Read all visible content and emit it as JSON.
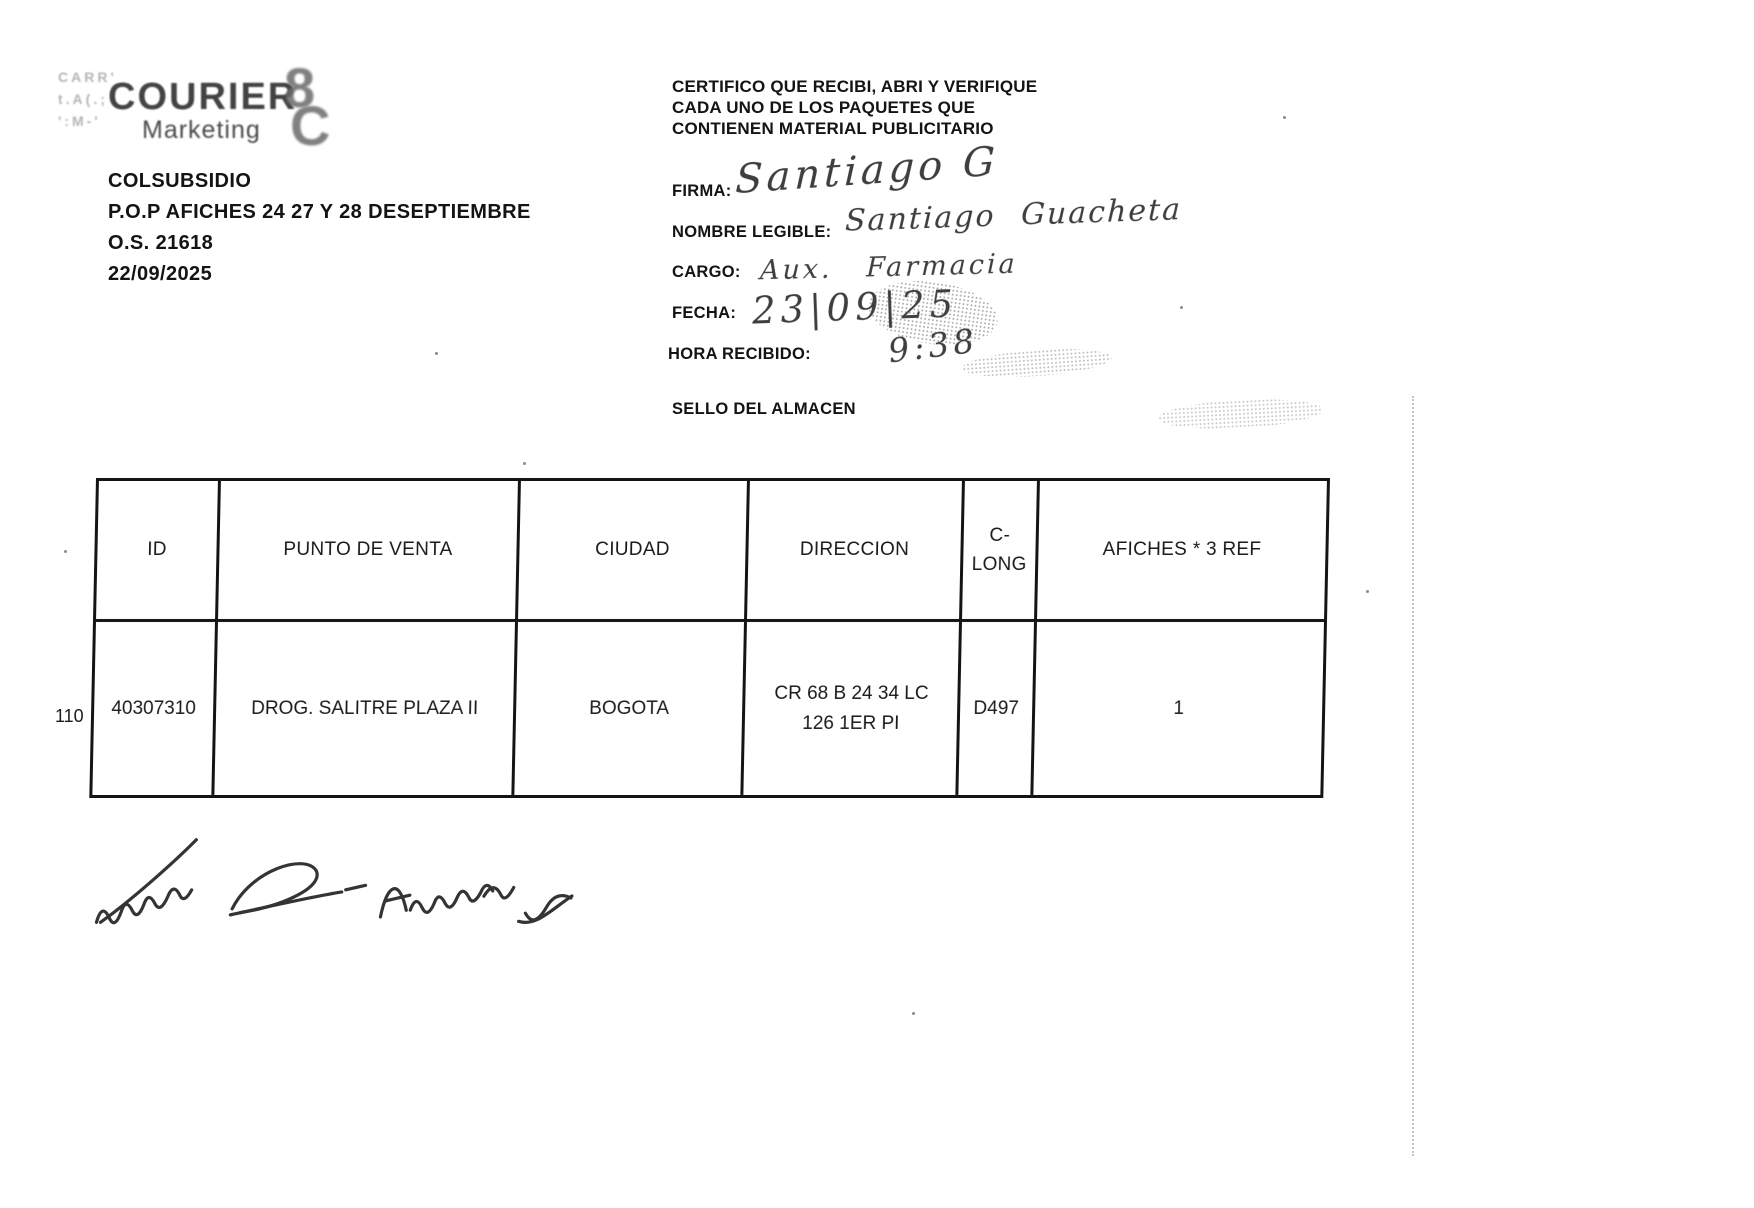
{
  "logo": {
    "name": "COURIER",
    "subname": "Marketing",
    "mark_glyph_top": "8",
    "mark_glyph_bottom": "C",
    "ghost_fragments": [
      "CARR'",
      "t.A(.;",
      "':M-'"
    ]
  },
  "shipment": {
    "client": "COLSUBSIDIO",
    "campaign": "P.O.P AFICHES 24 27 Y 28 DESEPTIEMBRE",
    "order": "O.S. 21618",
    "date": "22/09/2025"
  },
  "certification": {
    "line1": "CERTIFICO QUE RECIBI, ABRI Y VERIFIQUE",
    "line2": "CADA  UNO DE LOS PAQUETES QUE",
    "line3": "CONTIENEN MATERIAL PUBLICITARIO"
  },
  "form": {
    "firma": {
      "label": "FIRMA:",
      "value": "Santiago G"
    },
    "nombre": {
      "label": "NOMBRE LEGIBLE:",
      "value": "Santiago  Guacheta"
    },
    "cargo": {
      "label": "CARGO:",
      "value": "Aux. Farmacia"
    },
    "fecha": {
      "label": "FECHA:",
      "value": "23|09|25"
    },
    "hora": {
      "label": "HORA RECIBIDO:",
      "value": "9:38"
    },
    "sello": {
      "label": "SELLO DEL ALMACEN"
    }
  },
  "table": {
    "headers": [
      "ID",
      "PUNTO DE VENTA",
      "CIUDAD",
      "DIRECCION",
      "C-LONG",
      "AFICHES * 3 REF"
    ],
    "rows": [
      {
        "row_number": "110",
        "id": "40307310",
        "punto_de_venta": "DROG. SALITRE PLAZA II",
        "ciudad": "BOGOTA",
        "direccion": "CR 68 B 24 34 LC 126 1ER PI",
        "c_long": "D497",
        "afiches": "1"
      }
    ]
  },
  "bottom_signature": {
    "transcription": "Ibeima R - Adriana V"
  },
  "colors": {
    "ink": "#1c1c1c",
    "paper": "#ffffff"
  }
}
